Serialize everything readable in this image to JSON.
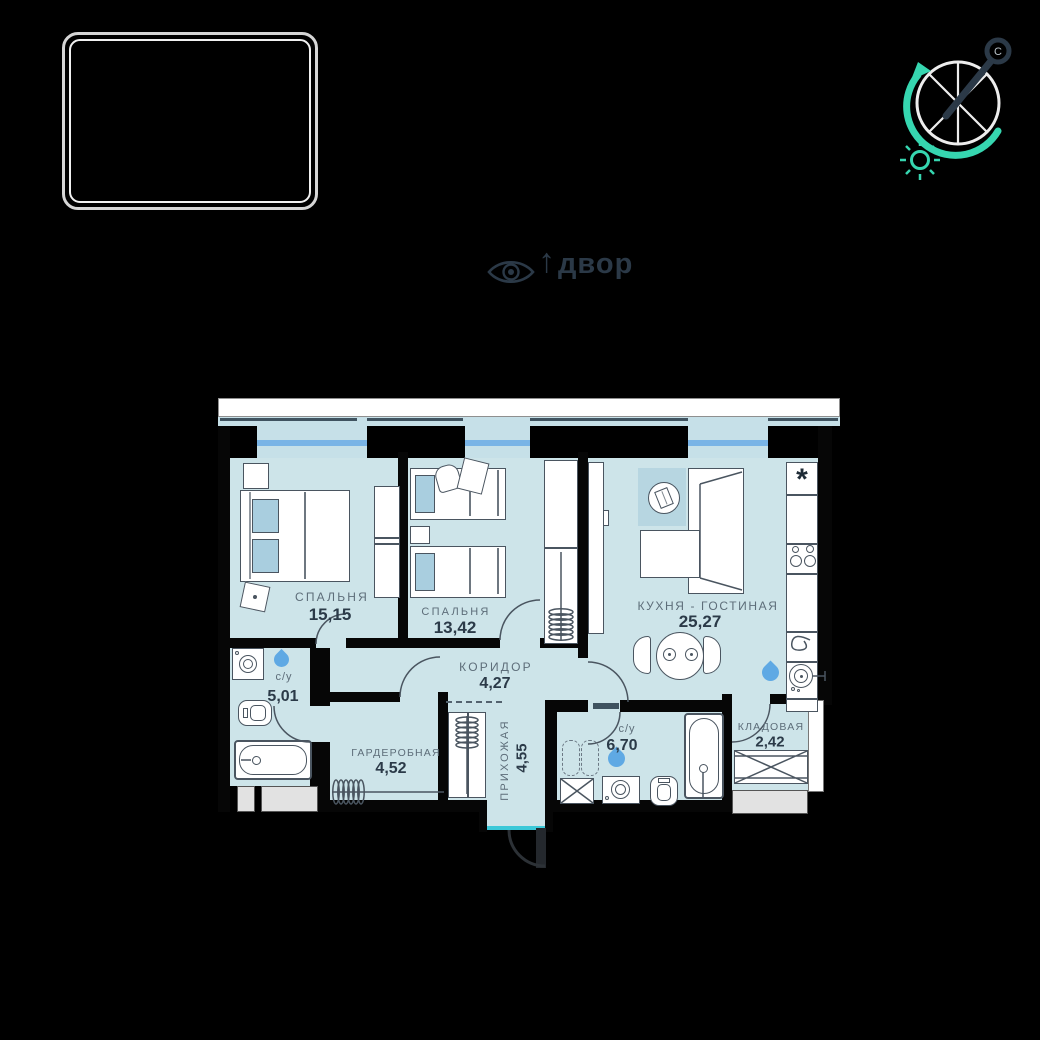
{
  "canvas": {
    "width": 1040,
    "height": 1040
  },
  "view_indicator": {
    "arrow": "↑",
    "label": "двор"
  },
  "compass": {
    "north_label": "С"
  },
  "plan": {
    "rooms": [
      {
        "key": "bedroom1",
        "name": "СПАЛЬНЯ",
        "area": "15,15"
      },
      {
        "key": "bedroom2",
        "name": "СПАЛЬНЯ",
        "area": "13,42"
      },
      {
        "key": "kitchen_living",
        "name": "КУХНЯ - ГОСТИНАЯ",
        "area": "25,27"
      },
      {
        "key": "corridor",
        "name": "КОРИДОР",
        "area": "4,27"
      },
      {
        "key": "bathroom1",
        "name": "с/у",
        "area": "5,01"
      },
      {
        "key": "wardrobe_room",
        "name": "ГАРДЕРОБНАЯ",
        "area": "4,52"
      },
      {
        "key": "hallway",
        "name": "ПРИХОЖАЯ",
        "area": "4,55"
      },
      {
        "key": "bathroom2",
        "name": "с/у",
        "area": "6,70"
      },
      {
        "key": "storage",
        "name": "КЛАДОВАЯ",
        "area": "2,42"
      }
    ],
    "fridge_mark": "*"
  },
  "colors": {
    "bg": "#000000",
    "wall": "#060606",
    "room_fill": "#cde4e9",
    "rug": "#b7d6e1",
    "window_glass": "#c6e0e8",
    "window_line": "#79b4e6",
    "lintel": "#3f5360",
    "furniture_line": "#4a5560",
    "label": "#5d6d79",
    "area_text": "#2b3a48",
    "drop": "#5fa9e4",
    "threshold": "#3bc8d8",
    "teal": "#36d6b0",
    "dark": "#2b3947",
    "exterior_box": "#e2e2e2",
    "ledge": "#ffffff",
    "pillow": "#a9cedf"
  }
}
